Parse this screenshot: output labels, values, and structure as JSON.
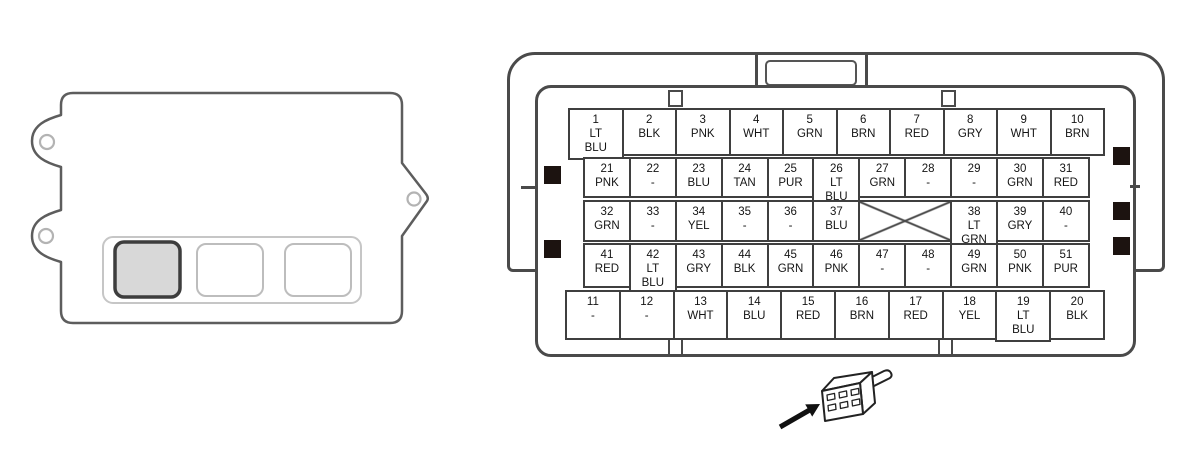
{
  "colors": {
    "line": "#4a4a4a",
    "text": "#141414",
    "highlight_fill": "#d8d8d8",
    "lock_tab": "#1c1310"
  },
  "module": {
    "slots": [
      {
        "id": 1,
        "highlighted": true
      },
      {
        "id": 2,
        "highlighted": false
      },
      {
        "id": 3,
        "highlighted": false
      }
    ]
  },
  "connector": {
    "rows": [
      {
        "name": "row-top",
        "cells": [
          {
            "pin": "1",
            "color": "LT BLU"
          },
          {
            "pin": "2",
            "color": "BLK"
          },
          {
            "pin": "3",
            "color": "PNK"
          },
          {
            "pin": "4",
            "color": "WHT"
          },
          {
            "pin": "5",
            "color": "GRN"
          },
          {
            "pin": "6",
            "color": "BRN"
          },
          {
            "pin": "7",
            "color": "RED"
          },
          {
            "pin": "8",
            "color": "GRY"
          },
          {
            "pin": "9",
            "color": "WHT"
          },
          {
            "pin": "10",
            "color": "BRN"
          }
        ]
      },
      {
        "name": "row-second",
        "cells": [
          {
            "pin": "21",
            "color": "PNK"
          },
          {
            "pin": "22",
            "color": "-"
          },
          {
            "pin": "23",
            "color": "BLU"
          },
          {
            "pin": "24",
            "color": "TAN"
          },
          {
            "pin": "25",
            "color": "PUR"
          },
          {
            "pin": "26",
            "color": "LT BLU"
          },
          {
            "pin": "27",
            "color": "GRN"
          },
          {
            "pin": "28",
            "color": "-"
          },
          {
            "pin": "29",
            "color": "-"
          },
          {
            "pin": "30",
            "color": "GRN"
          },
          {
            "pin": "31",
            "color": "RED"
          }
        ]
      },
      {
        "name": "row-middle",
        "cells": [
          {
            "pin": "32",
            "color": "GRN"
          },
          {
            "pin": "33",
            "color": "-"
          },
          {
            "pin": "34",
            "color": "YEL"
          },
          {
            "pin": "35",
            "color": "-"
          },
          {
            "pin": "36",
            "color": "-"
          },
          {
            "pin": "37",
            "color": "BLU"
          },
          {
            "blocked": true
          },
          {
            "pin": "38",
            "color": "LT GRN"
          },
          {
            "pin": "39",
            "color": "GRY"
          },
          {
            "pin": "40",
            "color": "-"
          }
        ]
      },
      {
        "name": "row-fourth",
        "cells": [
          {
            "pin": "41",
            "color": "RED"
          },
          {
            "pin": "42",
            "color": "LT BLU"
          },
          {
            "pin": "43",
            "color": "GRY"
          },
          {
            "pin": "44",
            "color": "BLK"
          },
          {
            "pin": "45",
            "color": "GRN"
          },
          {
            "pin": "46",
            "color": "PNK"
          },
          {
            "pin": "47",
            "color": "-"
          },
          {
            "pin": "48",
            "color": "-"
          },
          {
            "pin": "49",
            "color": "GRN"
          },
          {
            "pin": "50",
            "color": "PNK"
          },
          {
            "pin": "51",
            "color": "PUR"
          }
        ]
      },
      {
        "name": "row-bottom",
        "cells": [
          {
            "pin": "11",
            "color": "-"
          },
          {
            "pin": "12",
            "color": "-"
          },
          {
            "pin": "13",
            "color": "WHT"
          },
          {
            "pin": "14",
            "color": "BLU"
          },
          {
            "pin": "15",
            "color": "RED"
          },
          {
            "pin": "16",
            "color": "BRN"
          },
          {
            "pin": "17",
            "color": "RED"
          },
          {
            "pin": "18",
            "color": "YEL"
          },
          {
            "pin": "19",
            "color": "LT BLU"
          },
          {
            "pin": "20",
            "color": "BLK"
          }
        ]
      }
    ]
  }
}
